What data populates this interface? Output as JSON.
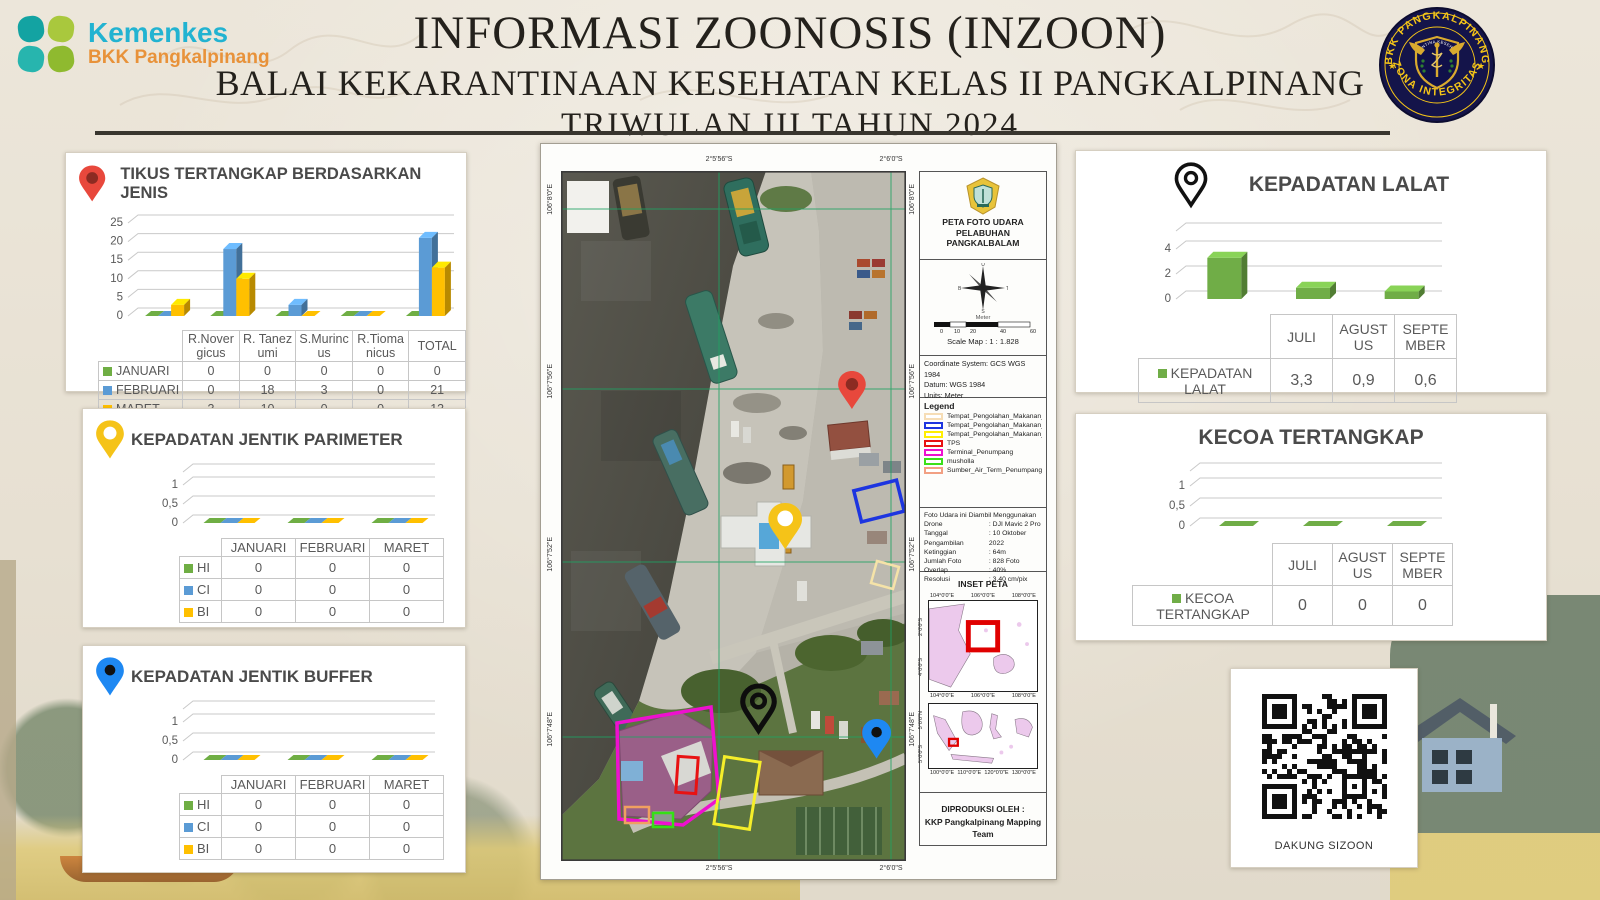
{
  "header": {
    "brand": {
      "name": "Kemenkes",
      "sub": "BKK Pangkalpinang"
    },
    "title1": "INFORMASI ZOONOSIS (INZOON)",
    "title2": "BALAI KEKARANTINAAN KESEHATAN KELAS II PANGKALPINANG",
    "title3": "TRIWULAN III TAHUN 2024",
    "badge": {
      "arc_top": "BKK PANGKALPINANG",
      "arc_bottom": "ZONA INTEGRITAS",
      "shield_text": "KARANTINA KESEHATAN"
    }
  },
  "chart_data": [
    {
      "type": "bar",
      "title": "TIKUS TERTANGKAP BERDASARKAN JENIS",
      "categories": [
        "R.Novergicus",
        "R. Tanezumi",
        "S.Murincus",
        "R.Tiomanicus",
        "TOTAL"
      ],
      "ylim": [
        0,
        25
      ],
      "ytick_labels": [
        "25",
        "20",
        "15",
        "10",
        "5",
        "0"
      ],
      "series": [
        {
          "name": "JANUARI",
          "color": "#6fae44",
          "values": [
            0,
            0,
            0,
            0,
            0
          ],
          "labels": [
            "0",
            "0",
            "0",
            "0",
            "0"
          ]
        },
        {
          "name": "FEBRUARI",
          "color": "#5b9bd5",
          "values": [
            0,
            18,
            3,
            0,
            21
          ],
          "labels": [
            "0",
            "18",
            "3",
            "0",
            "21"
          ]
        },
        {
          "name": "MARET",
          "color": "#ffc000",
          "values": [
            3,
            10,
            0,
            0,
            13
          ],
          "labels": [
            "3",
            "10",
            "0",
            "0",
            "13"
          ]
        }
      ]
    },
    {
      "type": "bar",
      "title": "KEPADATAN JENTIK PARIMETER",
      "categories": [
        "JANUARI",
        "FEBRUARI",
        "MARET"
      ],
      "ylim": [
        0,
        1
      ],
      "ytick_labels": [
        "1",
        "0,5",
        "0"
      ],
      "series": [
        {
          "name": "HI",
          "color": "#6fae44",
          "values": [
            0,
            0,
            0
          ],
          "labels": [
            "0",
            "0",
            "0"
          ]
        },
        {
          "name": "CI",
          "color": "#5b9bd5",
          "values": [
            0,
            0,
            0
          ],
          "labels": [
            "0",
            "0",
            "0"
          ]
        },
        {
          "name": "BI",
          "color": "#ffc000",
          "values": [
            0,
            0,
            0
          ],
          "labels": [
            "0",
            "0",
            "0"
          ]
        }
      ]
    },
    {
      "type": "bar",
      "title": "KEPADATAN JENTIK BUFFER",
      "categories": [
        "JANUARI",
        "FEBRUARI",
        "MARET"
      ],
      "ylim": [
        0,
        1
      ],
      "ytick_labels": [
        "1",
        "0,5",
        "0"
      ],
      "series": [
        {
          "name": "HI",
          "color": "#6fae44",
          "values": [
            0,
            0,
            0
          ],
          "labels": [
            "0",
            "0",
            "0"
          ]
        },
        {
          "name": "CI",
          "color": "#5b9bd5",
          "values": [
            0,
            0,
            0
          ],
          "labels": [
            "0",
            "0",
            "0"
          ]
        },
        {
          "name": "BI",
          "color": "#ffc000",
          "values": [
            0,
            0,
            0
          ],
          "labels": [
            "0",
            "0",
            "0"
          ]
        }
      ]
    },
    {
      "type": "bar",
      "title": "KEPADATAN LALAT",
      "categories": [
        "JULI",
        "AGUSTUS",
        "SEPTEMBER"
      ],
      "ylim": [
        0,
        4
      ],
      "ytick_labels": [
        "4",
        "2",
        "0"
      ],
      "series": [
        {
          "name": "KEPADATAN LALAT",
          "color": "#70ad47",
          "values": [
            3.3,
            0.9,
            0.6
          ],
          "labels": [
            "3,3",
            "0,9",
            "0,6"
          ]
        }
      ]
    },
    {
      "type": "bar",
      "title": "KECOA TERTANGKAP",
      "categories": [
        "JULI",
        "AGUSTUS",
        "SEPTEMBER"
      ],
      "ylim": [
        0,
        1
      ],
      "ytick_labels": [
        "1",
        "0,5",
        "0"
      ],
      "series": [
        {
          "name": "KECOA TERTANGKAP",
          "color": "#70ad47",
          "values": [
            0,
            0,
            0
          ],
          "labels": [
            "0",
            "0",
            "0"
          ]
        }
      ]
    }
  ],
  "map": {
    "photo": {
      "top_labels": [
        "2°5'56\"S",
        "2°6'0\"S"
      ],
      "bottom_labels": [
        "2°5'56\"S",
        "2°6'0\"S"
      ],
      "left_labels": [
        "106°8'0\"E",
        "106°7'56\"E",
        "106°7'52\"E",
        "106°7'48\"E"
      ],
      "right_labels": [
        "106°8'0\"E",
        "106°7'56\"E",
        "106°7'52\"E",
        "106°7'48\"E"
      ]
    },
    "panel": {
      "title1": "PETA FOTO UDARA",
      "title2": "PELABUHAN PANGKALBALAM",
      "compass": {
        "n": "U",
        "e": "T",
        "s": "S",
        "w": "B"
      },
      "scale_unit": "Meter",
      "scale_ticks": [
        "0",
        "10",
        "20",
        "40",
        "60"
      ],
      "scale_text": "Scale Map : 1 : 1.828",
      "coord_lines": [
        "Coordinate System: GCS WGS 1984",
        "Datum: WGS 1984",
        "Units: Meter"
      ],
      "legend_title": "Legend",
      "legend": [
        {
          "label": "Tempat_Pengolahan_Makanan_3",
          "color": "#f6ddb5"
        },
        {
          "label": "Tempat_Pengolahan_Makanan_2",
          "color": "#1d35e0"
        },
        {
          "label": "Tempat_Pengolahan_Makanan_1",
          "color": "#ffee00"
        },
        {
          "label": "TPS",
          "color": "#e81212"
        },
        {
          "label": "Terminal_Penumpang",
          "color": "#ee10cf"
        },
        {
          "label": "musholla",
          "color": "#3be019"
        },
        {
          "label": "Sumber_Air_Term_Penumpang",
          "color": "#f2a083"
        }
      ],
      "drone_intro": "Foto Udara ini Diambil Menggunakan",
      "drone_rows": [
        [
          "Drone",
          ": DJI Mavic 2 Pro"
        ],
        [
          "Tanggal Pengambilan",
          ": 10 Oktober 2022"
        ],
        [
          "Ketinggian",
          ": 64m"
        ],
        [
          "Jumlah Foto",
          ": 828 Foto"
        ],
        [
          "Overlap",
          ": 40%"
        ],
        [
          "Resolusi",
          ": 3,40 cm/pix"
        ]
      ],
      "inset_title": "INSET PETA",
      "inset1_x": [
        "104°0'0\"E",
        "106°0'0\"E",
        "108°0'0\"E"
      ],
      "inset1_y": [
        "2°0'0\"S",
        "4°0'0\"S"
      ],
      "inset2_x": [
        "100°0'0\"E",
        "110°0'0\"E",
        "120°0'0\"E",
        "130°0'0\"E"
      ],
      "inset2_y": [
        "5°0'0\"N",
        "5°0'0\"S"
      ],
      "produced1": "DIPRODUKSI OLEH :",
      "produced2": "KKP Pangkalpinang Mapping Team"
    }
  },
  "qr": {
    "caption": "DAKUNG SIZOON"
  }
}
